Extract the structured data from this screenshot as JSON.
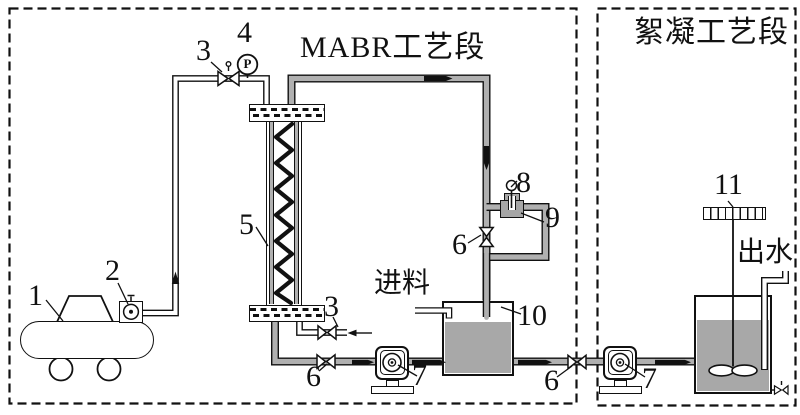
{
  "sections": {
    "mabr": {
      "title": "MABR工艺段"
    },
    "flocculation": {
      "title": "絮凝工艺段"
    }
  },
  "stream_labels": {
    "feed": "进料",
    "effluent": "出水"
  },
  "instrument": {
    "pressure_gauge_letter": "P"
  },
  "component_numbers": {
    "air_compressor": "1",
    "air_flow_gauge": "2",
    "air_inlet_valve": "3",
    "pressure_gauge": "4",
    "membrane_column": "5",
    "exhaust_valve": "3",
    "column_drain_valve": "6",
    "recirculation_pump": "7",
    "sensor_probe": "8",
    "flow_cell": "9",
    "loop_valve": "6",
    "feed_tank": "10",
    "transfer_valve": "6",
    "transfer_pump": "7",
    "stirrer_motor": "11"
  },
  "colors": {
    "line": "#111111",
    "pipe_gray": "#b0b0b0",
    "liquid_gray": "#a8a8a8",
    "background": "#ffffff"
  }
}
